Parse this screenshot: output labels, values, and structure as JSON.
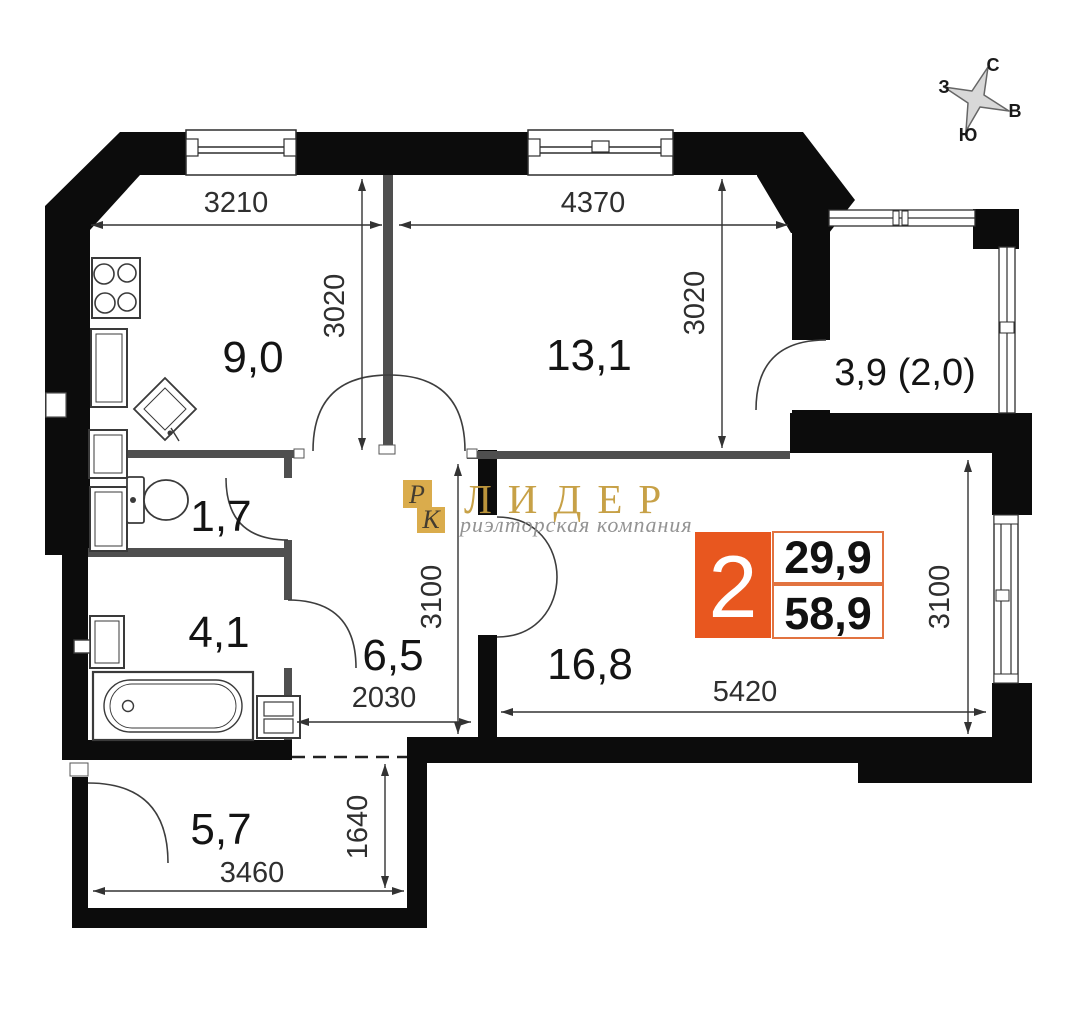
{
  "compass": {
    "north": "С",
    "east": "В",
    "south": "Ю",
    "west": "З"
  },
  "rooms": {
    "kitchen": {
      "area": "9,0"
    },
    "room": {
      "area": "13,1"
    },
    "balcony": {
      "area": "3,9 (2,0)"
    },
    "wc": {
      "area": "1,7"
    },
    "bathroom": {
      "area": "4,1"
    },
    "hallway": {
      "area": "6,5"
    },
    "living_room": {
      "area": "16,8"
    },
    "entry": {
      "area": "5,7"
    }
  },
  "dimensions_mm": {
    "kitchen_width": "3210",
    "room_width": "4370",
    "kitchen_depth": "3020",
    "room_depth": "3020",
    "living_depth_left": "3100",
    "living_depth_right": "3100",
    "hallway_width": "2030",
    "living_width": "5420",
    "entry_depth": "1640",
    "entry_width": "3460"
  },
  "info_badge": {
    "room_count": "2",
    "living_area": "29,9",
    "total_area": "58,9",
    "accent_color": "#E8571F"
  },
  "watermark": {
    "initial_1": "Р",
    "initial_2": "К",
    "company": "ЛИДЕР",
    "tagline": "риэлторская компания",
    "gold_color": "#D9A843"
  },
  "colors": {
    "walls": "#0c0c0c",
    "inner_walls": "#4f4f4f",
    "dimension_lines": "#333333"
  }
}
